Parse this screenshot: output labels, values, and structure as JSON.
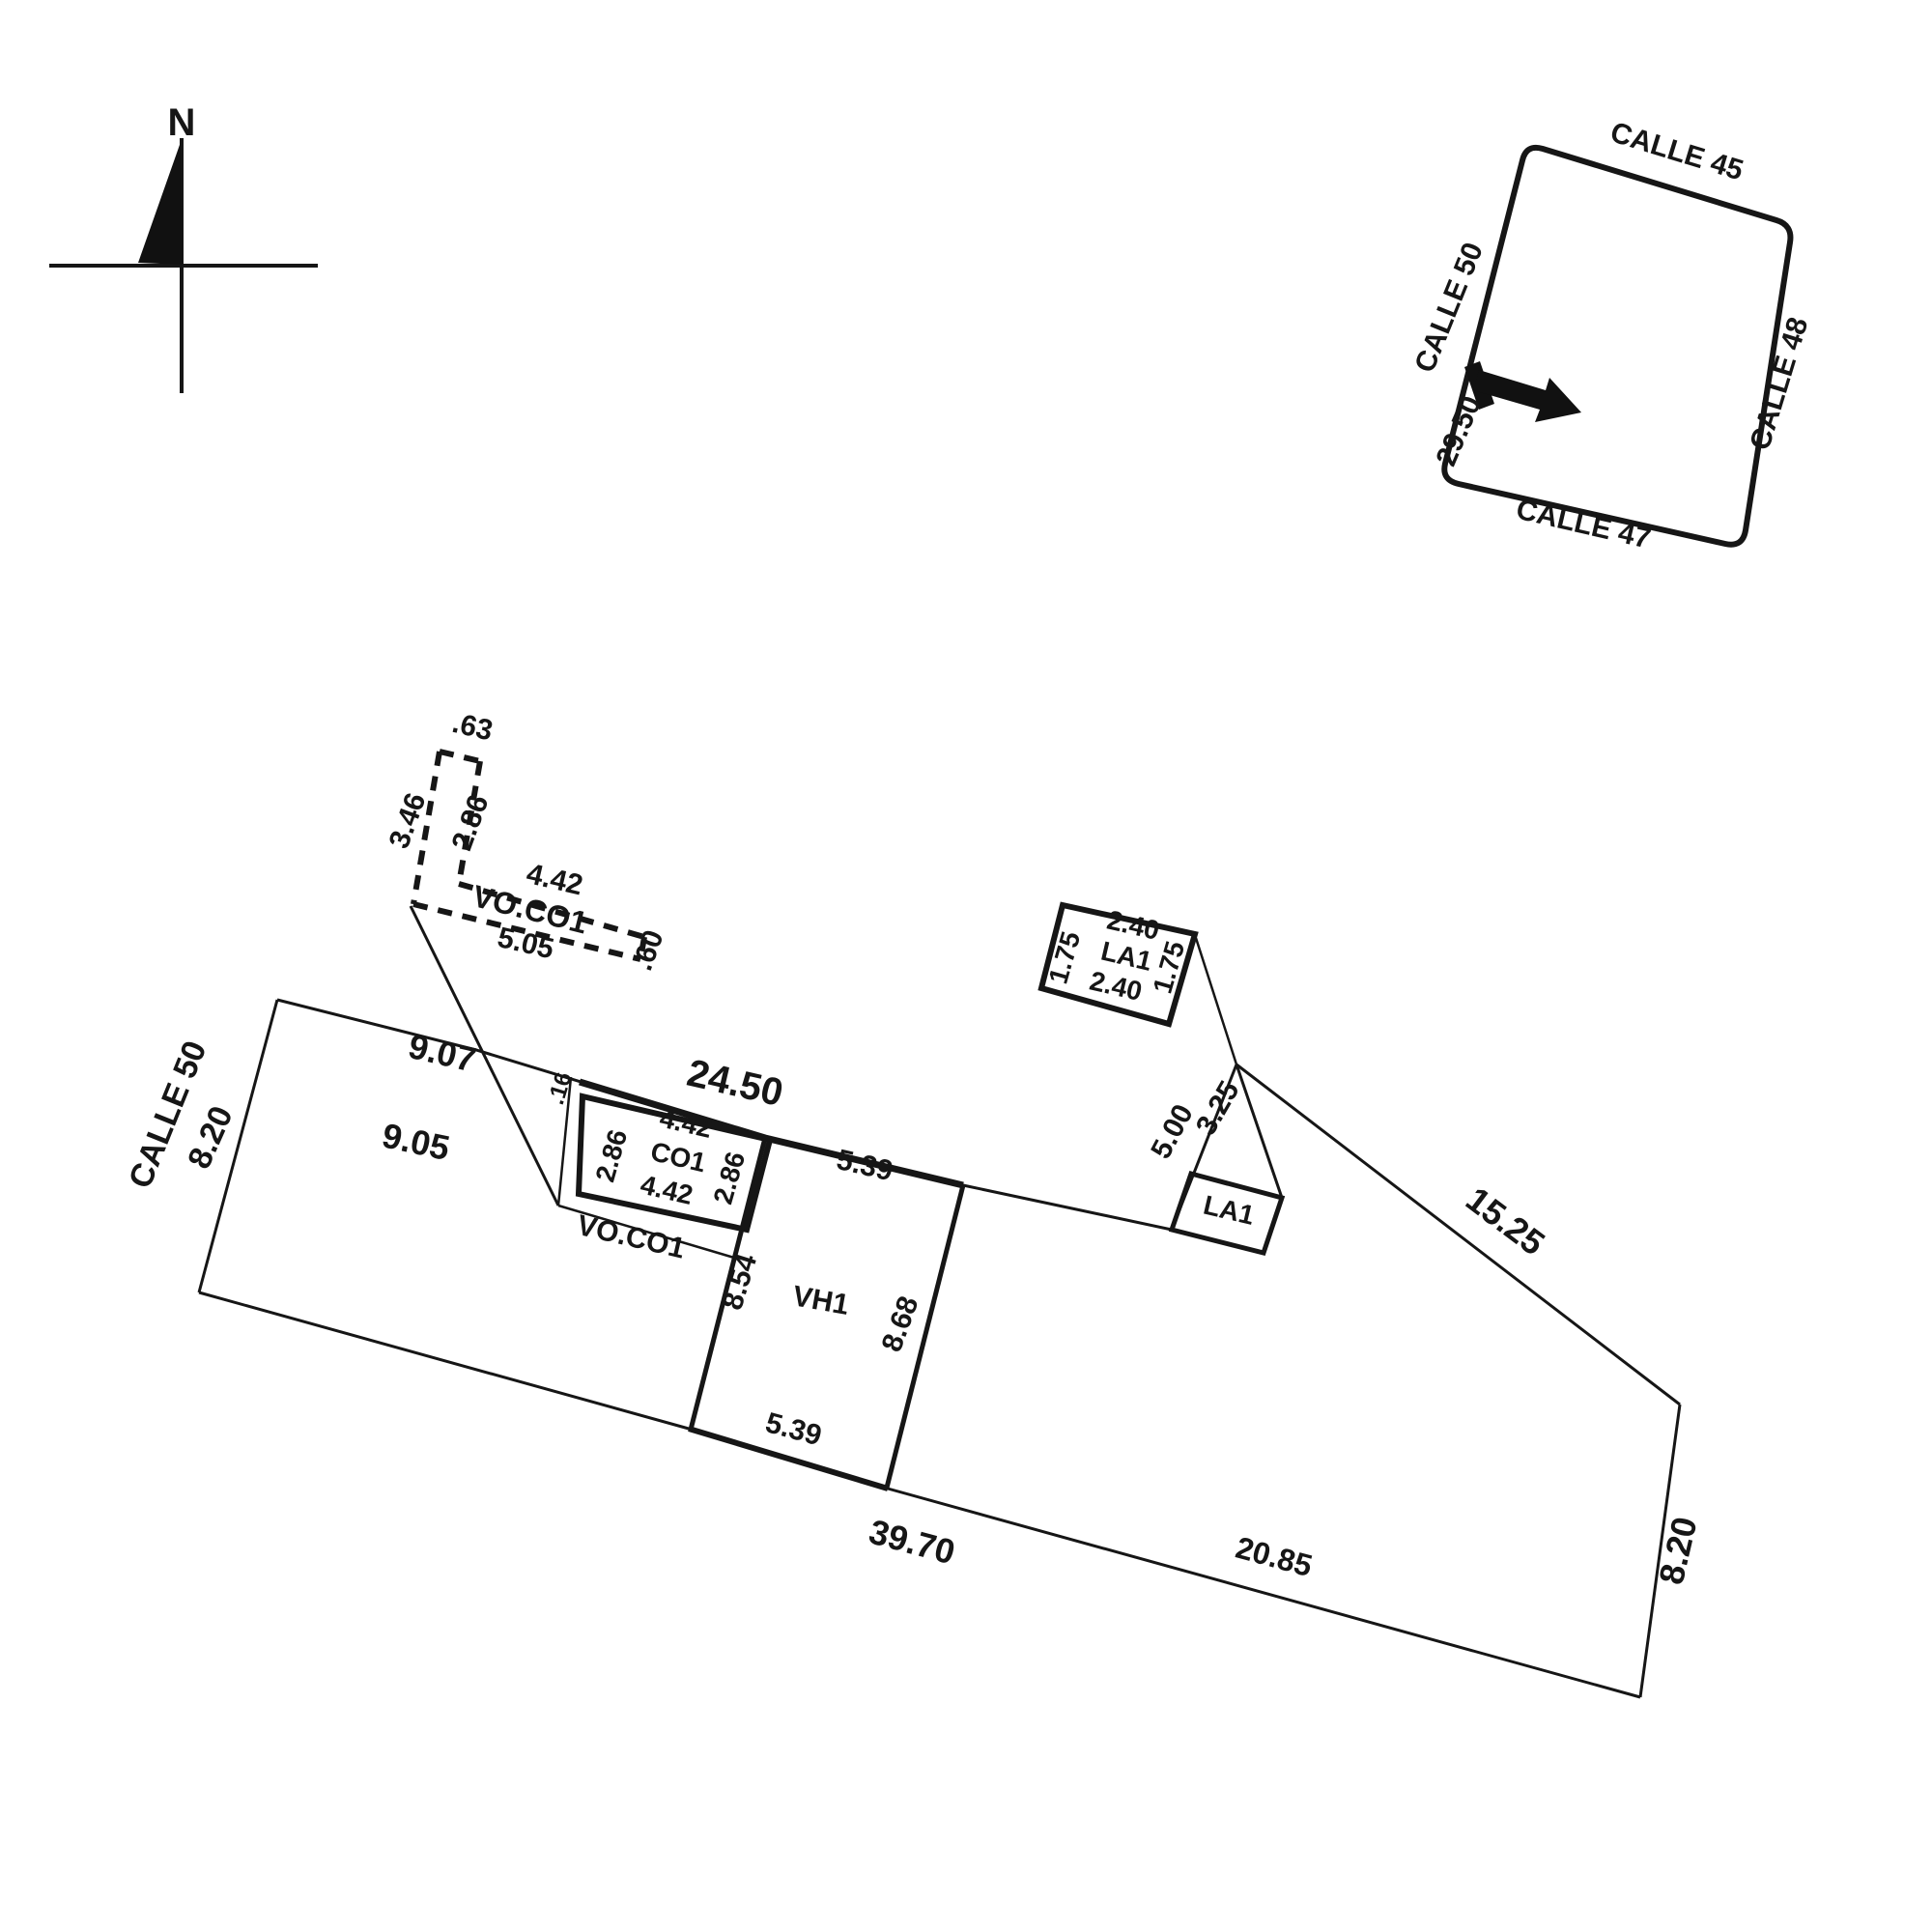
{
  "north_arrow": {
    "label": "N"
  },
  "location_map": {
    "street_top": "CALLE 45",
    "street_right": "CALLE 48",
    "street_bottom": "CALLE 47",
    "street_left": "CALLE 50",
    "frontage": "29.50"
  },
  "plan": {
    "street": "CALLE 50",
    "left_side": "8.20",
    "top_seg1": "9.07",
    "interior_diag": "9.05",
    "top_seg2": "24.50",
    "right_upper": "15.25",
    "right_side": "8.20",
    "bottom_seg1": "39.70",
    "bottom_seg2": "20.85",
    "apex_left": "5.00",
    "apex_right": "3.25"
  },
  "dashed_structure": {
    "label": "VO.CO1",
    "top": ".63",
    "outer_left": "3.46",
    "inner_left": "2.86",
    "top_len": "4.42",
    "bottom_len": "5.05",
    "end": ".60"
  },
  "co1": {
    "label": "CO1",
    "offset": ".16",
    "top": "4.42",
    "left": "2.86",
    "right": "2.86",
    "bottom": "4.42",
    "porch_label": "VO.CO1"
  },
  "vh1": {
    "label": "VH1",
    "top": "5.39",
    "left": "8.54",
    "right": "8.68",
    "bottom": "5.39"
  },
  "la1": {
    "plan_label": "LA1",
    "detail": {
      "label": "LA1",
      "top": "2.40",
      "left": "1.75",
      "right": "1.75",
      "bottom": "2.40"
    }
  }
}
